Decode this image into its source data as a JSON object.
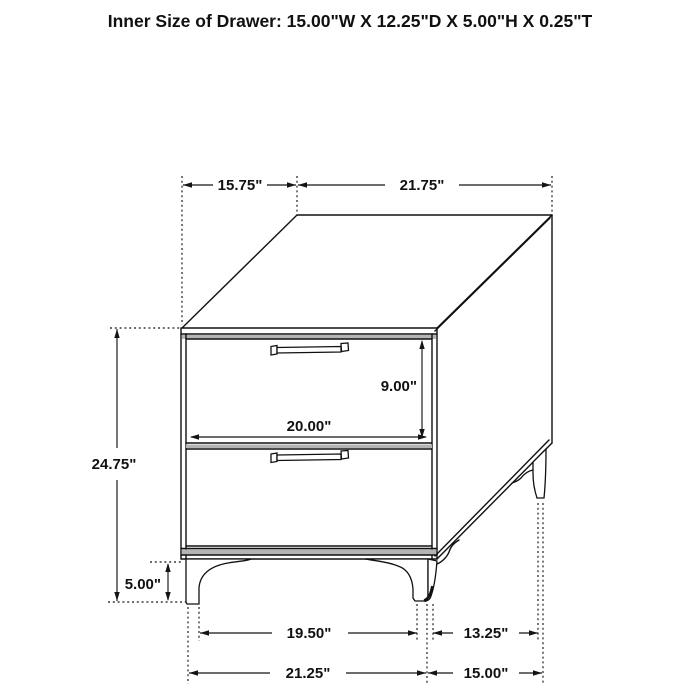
{
  "title": "Inner Size of Drawer: 15.00\"W X 12.25\"D X 5.00\"H X 0.25\"T",
  "dims": {
    "top_width": "15.75\"",
    "top_depth": "21.75\"",
    "overall_height": "24.75\"",
    "leg_height": "5.00\"",
    "drawer_front_height": "9.00\"",
    "drawer_front_width": "20.00\"",
    "front_leg_inner_span": "19.50\"",
    "side_leg_inner_span": "13.25\"",
    "front_leg_outer_span": "21.25\"",
    "side_leg_outer_span": "15.00\""
  },
  "colors": {
    "line": "#111111",
    "rail_shading": "#b4b4b4",
    "background": "#ffffff"
  }
}
